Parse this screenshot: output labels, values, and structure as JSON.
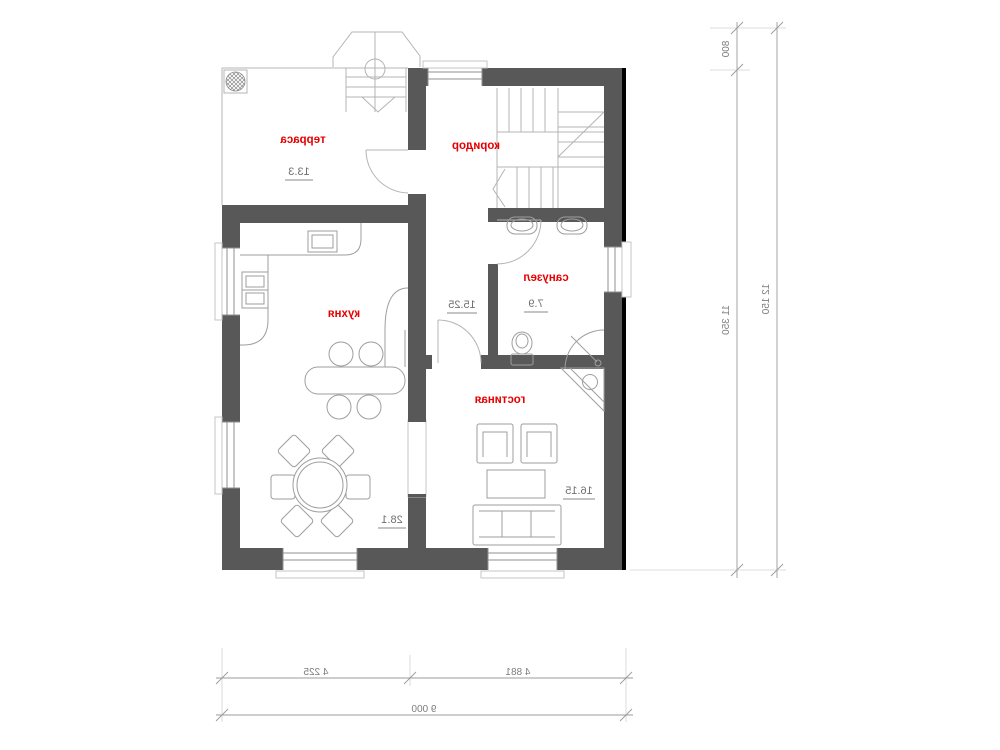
{
  "plan": {
    "rooms": [
      {
        "id": "terrace",
        "name": "терраса",
        "area": "13.3"
      },
      {
        "id": "corridor",
        "name": "коридор",
        "area": "15.25"
      },
      {
        "id": "bathroom",
        "name": "санузел",
        "area": "7.9"
      },
      {
        "id": "kitchen",
        "name": "кухня",
        "area": "28.1"
      },
      {
        "id": "living",
        "name": "гостиная",
        "area": "16.15"
      }
    ],
    "dimensions": {
      "right_top": "800",
      "right_main": "11 350",
      "right_total": "12 150",
      "bottom_left": "4 225",
      "bottom_right": "4 881",
      "bottom_total": "9 000"
    },
    "colors": {
      "wall": "#585858",
      "label": "#e60000",
      "accent": "#3232c0",
      "line": "#9b9b9b",
      "area-text": "#6f6f6f"
    }
  }
}
